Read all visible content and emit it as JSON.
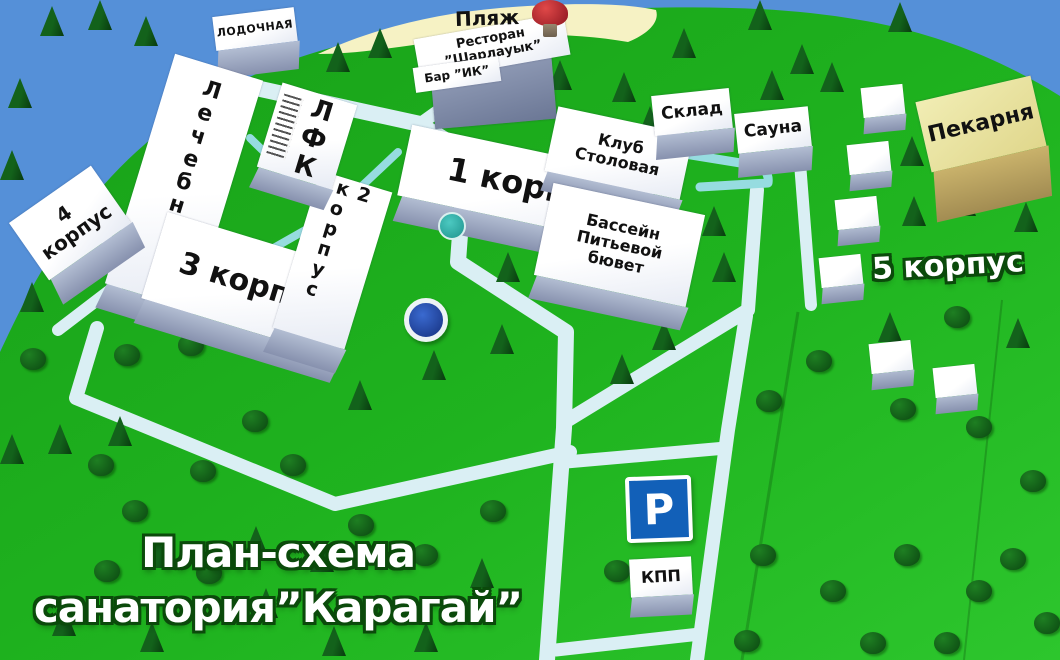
{
  "title": {
    "line1": "План-схема",
    "line2": "санатория”Карагай”"
  },
  "labels": {
    "beach": "Пляж",
    "boat_station": "ЛОДОЧНАЯ",
    "restaurant": "Ресторан\n”Шарлауык”",
    "bar": "Бар ”ИК”",
    "med_center": "Лечебница",
    "lfk": "ЛФК",
    "korpus1": "1 корпус",
    "korpus2": "2 корпус",
    "korpus3": "3 корпус",
    "korpus4": "4\nкорпус",
    "korpus5": "5 корпус",
    "club_dining": "Клуб\nСтоловая",
    "pool": "Бассейн\nПитьевой\nбювет",
    "warehouse": "Склад",
    "sauna": "Сауна",
    "bakery": "Пекарня",
    "checkpoint": "КПП",
    "parking": "P"
  },
  "colors": {
    "water": "#5590d8",
    "land_dark": "#18a018",
    "land_bright": "#2dc62d",
    "sand": "#f6f2c4",
    "road": "#daeff4",
    "path_teal": "#96dce0",
    "roof_white": "#ffffff",
    "building_side": "#8791ae",
    "bakery_roof": "#ece8a8",
    "parking_blue": "#1260b8",
    "title_outline": "#0b4a0b"
  },
  "map": {
    "pines": [
      [
        8,
        78
      ],
      [
        40,
        6
      ],
      [
        88,
        0
      ],
      [
        134,
        16
      ],
      [
        0,
        150
      ],
      [
        326,
        42
      ],
      [
        368,
        28
      ],
      [
        548,
        60
      ],
      [
        612,
        72
      ],
      [
        672,
        28
      ],
      [
        748,
        0
      ],
      [
        790,
        44
      ],
      [
        888,
        2
      ],
      [
        638,
        106
      ],
      [
        760,
        70
      ],
      [
        702,
        206
      ],
      [
        712,
        252
      ],
      [
        902,
        196
      ],
      [
        952,
        186
      ],
      [
        1014,
        202
      ],
      [
        878,
        312
      ],
      [
        1006,
        318
      ],
      [
        900,
        136
      ],
      [
        20,
        282
      ],
      [
        0,
        434
      ],
      [
        48,
        424
      ],
      [
        108,
        416
      ],
      [
        146,
        538
      ],
      [
        244,
        526
      ],
      [
        310,
        542
      ],
      [
        52,
        606
      ],
      [
        140,
        622
      ],
      [
        254,
        588
      ],
      [
        322,
        626
      ],
      [
        414,
        622
      ],
      [
        496,
        252
      ],
      [
        490,
        324
      ],
      [
        422,
        350
      ],
      [
        348,
        380
      ],
      [
        610,
        354
      ],
      [
        652,
        320
      ],
      [
        470,
        558
      ],
      [
        820,
        62
      ]
    ],
    "bushes": [
      [
        20,
        348
      ],
      [
        114,
        344
      ],
      [
        178,
        334
      ],
      [
        244,
        324
      ],
      [
        88,
        454
      ],
      [
        190,
        460
      ],
      [
        122,
        500
      ],
      [
        280,
        454
      ],
      [
        242,
        410
      ],
      [
        348,
        514
      ],
      [
        412,
        544
      ],
      [
        480,
        500
      ],
      [
        604,
        560
      ],
      [
        750,
        544
      ],
      [
        820,
        580
      ],
      [
        894,
        544
      ],
      [
        966,
        580
      ],
      [
        734,
        630
      ],
      [
        860,
        632
      ],
      [
        934,
        632
      ],
      [
        1034,
        612
      ],
      [
        1000,
        548
      ],
      [
        944,
        306
      ],
      [
        890,
        398
      ],
      [
        966,
        416
      ],
      [
        1020,
        470
      ],
      [
        806,
        350
      ],
      [
        756,
        390
      ],
      [
        196,
        562
      ],
      [
        352,
        598
      ],
      [
        94,
        560
      ]
    ],
    "cottages": [
      [
        862,
        86
      ],
      [
        848,
        143
      ],
      [
        836,
        198
      ],
      [
        820,
        256
      ],
      [
        870,
        342
      ],
      [
        934,
        366
      ]
    ]
  }
}
